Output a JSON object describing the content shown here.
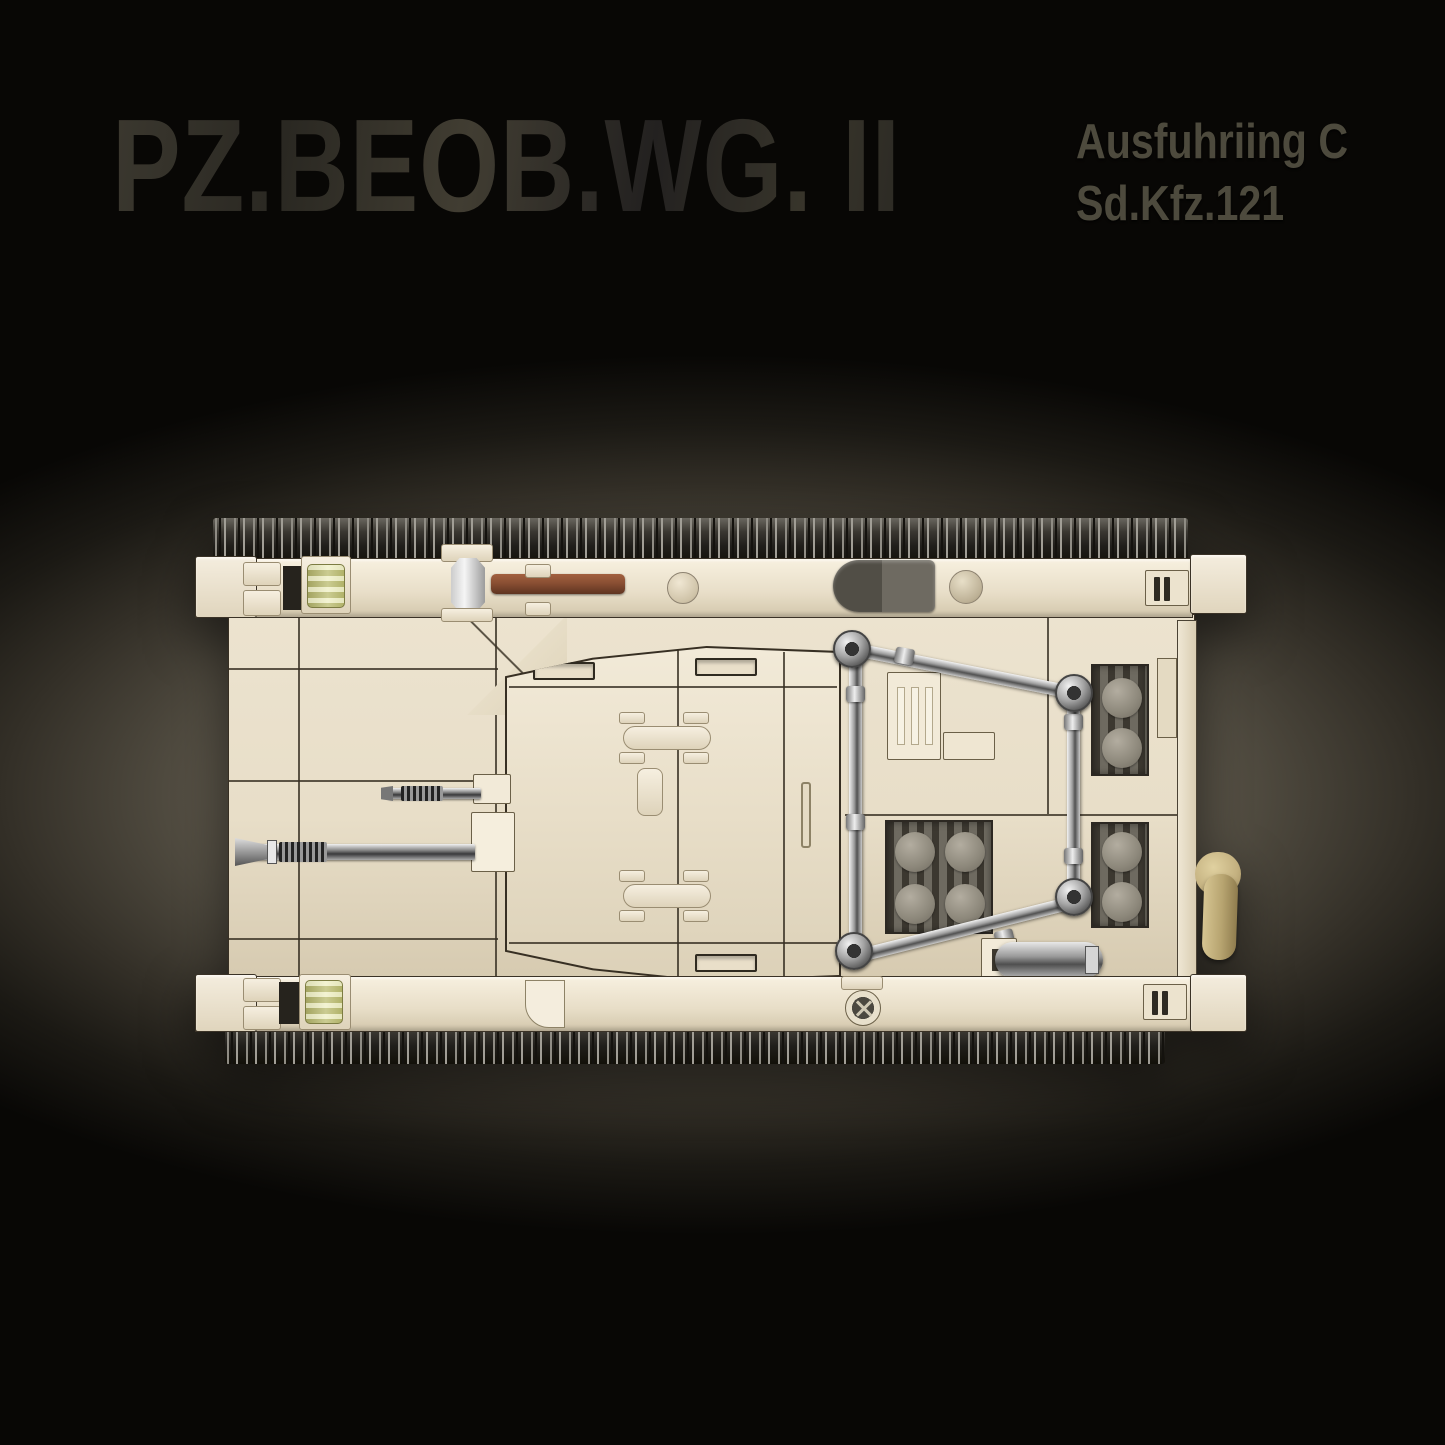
{
  "header": {
    "title": "PZ.BEOB.WG. II",
    "subtitle_line1": "Ausfuhriing C",
    "subtitle_line2": "Sd.Kfz.121"
  },
  "colors": {
    "bg_edge": "#080705",
    "bg_mid": "#4f4a3f",
    "bg_glow": "#7d7567",
    "subtitle": "#4d4a3d",
    "outline": "#372f23",
    "hull_light": "#f2ead8",
    "hull_mid": "#e8dec8",
    "hull_dark": "#d3c7ac",
    "track_dark": "#211f1b",
    "track_light": "#8f8c84",
    "grille_dark": "#6e6a60",
    "grille_bar": "#3c3830",
    "grille_cap": "#8d887b",
    "silver_light": "#f2f2f2",
    "silver_mid": "#9e9e9e",
    "silver_dark": "#515151",
    "brown_tool": "#8a4f33",
    "gear_yellow": "#e7e8a6",
    "exhaust_tan": "#c4b180"
  }
}
